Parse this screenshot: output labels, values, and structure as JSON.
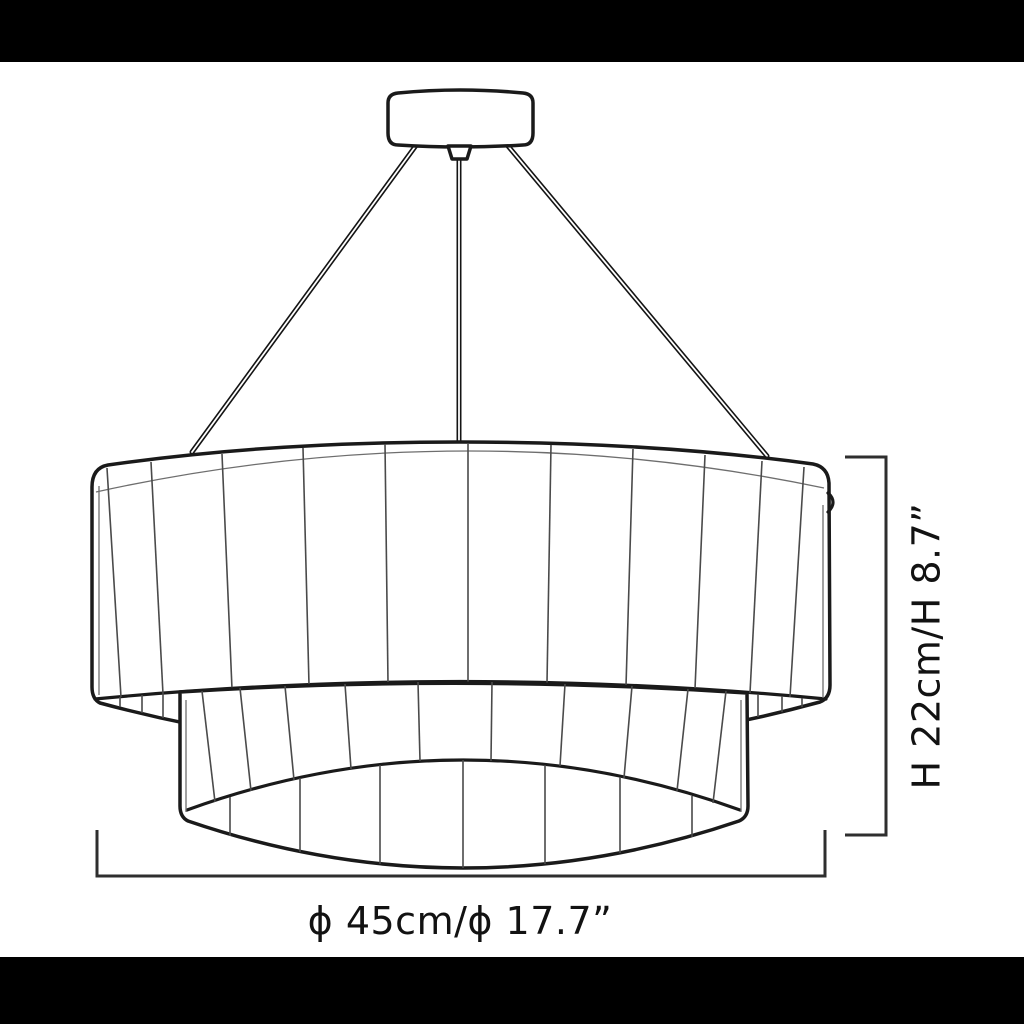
{
  "canvas": {
    "background": "#ffffff",
    "letterbox_color": "#000000"
  },
  "diagram": {
    "kind": "product-dimension-drawing",
    "subject": "two-tier fluted drum pendant chandelier",
    "line_color": "#1a1a1a",
    "panel_line_color": "#4a4a4a",
    "dimension_line_color": "#2e2e2e",
    "annotations": {
      "height_label": "H 22cm/H 8.7”",
      "diameter_label": "ϕ 45cm/ϕ 17.7”",
      "height_cm": "22",
      "height_in": "8.7",
      "diameter_cm": "45",
      "diameter_in": "17.7"
    }
  }
}
